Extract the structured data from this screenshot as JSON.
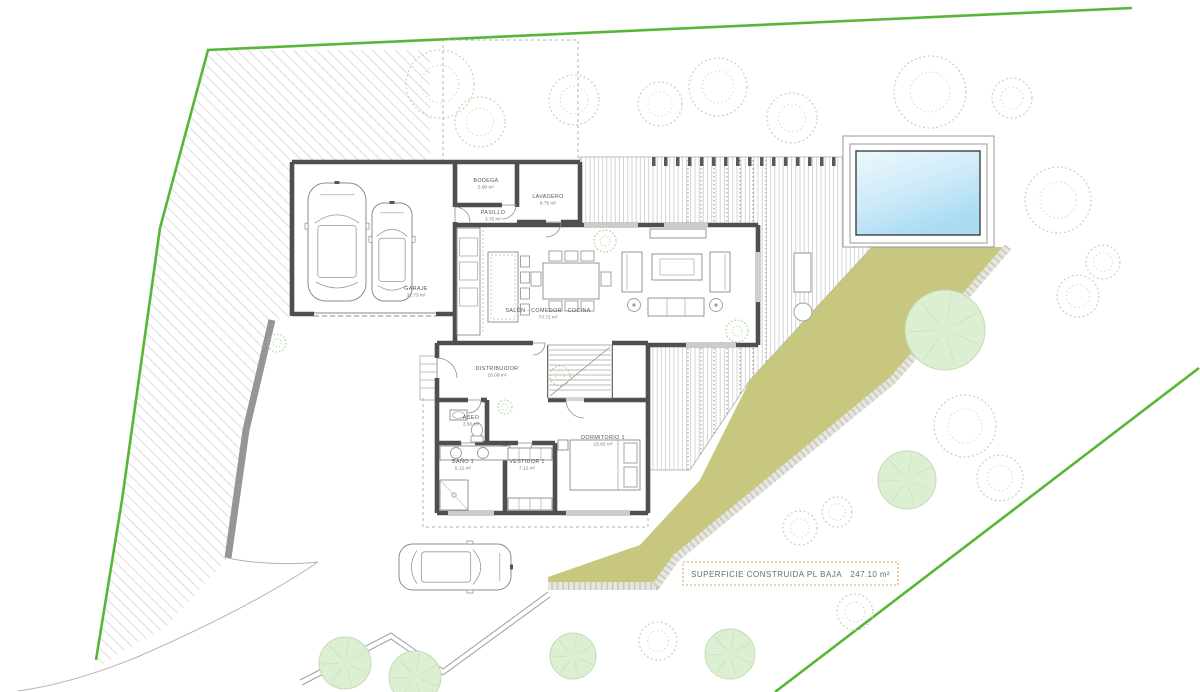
{
  "plan": {
    "rooms": [
      {
        "name": "BODEGA",
        "area": "5.90 m²"
      },
      {
        "name": "LAVADERO",
        "area": "6.75 m²"
      },
      {
        "name": "PASILLO",
        "area": "3.75 m²"
      },
      {
        "name": "GARAJE",
        "area": "32.73 m²"
      },
      {
        "name": "SALÓN - COMEDOR - COCINA",
        "area": "73.71 m²"
      },
      {
        "name": "DISTRIBUIDOR",
        "area": "16.09 m²"
      },
      {
        "name": "ASEO",
        "area": "3.50 m²"
      },
      {
        "name": "BAÑO 1",
        "area": "5.12 m²"
      },
      {
        "name": "VESTIDOR 1",
        "area": "7.12 m²"
      },
      {
        "name": "DORMITORIO 1",
        "area": "15.82 m²"
      }
    ],
    "summary": {
      "label": "SUPERFICIE CONSTRUIDA PL BAJA",
      "value": "247.10 m²"
    },
    "colors": {
      "boundary_green": "#58b637",
      "garden_band": "#c7c77f",
      "pool_water": "#bfe3f6",
      "wall_gray": "#4f4f4f",
      "accent_tan": "#d79f63"
    }
  }
}
